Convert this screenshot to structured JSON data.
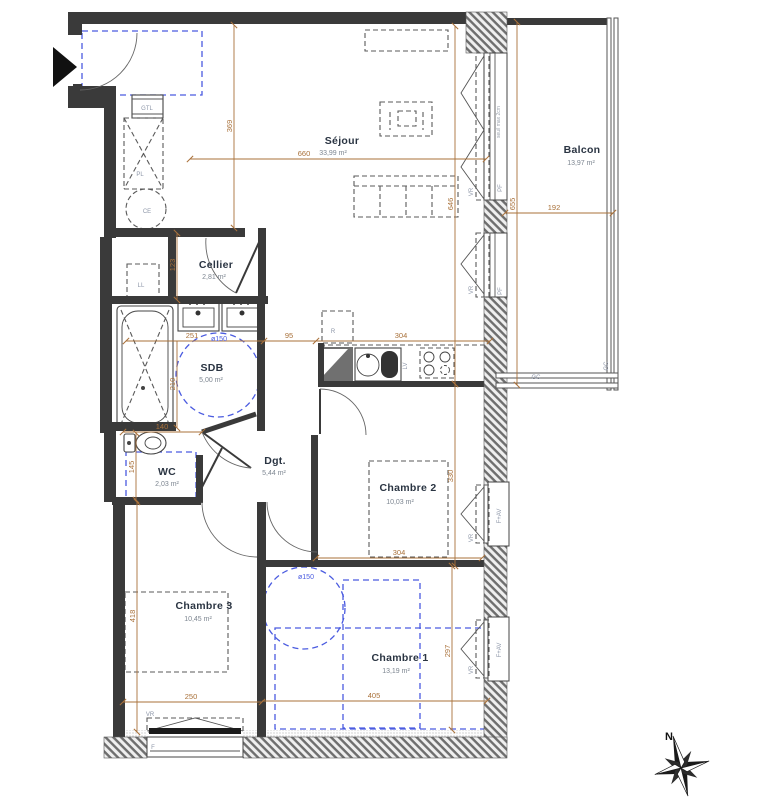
{
  "rooms": {
    "sejour": {
      "name": "Séjour",
      "area": "33,99 m²"
    },
    "balcon": {
      "name": "Balcon",
      "area": "13,97 m²"
    },
    "cellier": {
      "name": "Cellier",
      "area": "2,81 m²"
    },
    "sdb": {
      "name": "SDB",
      "area": "5,00 m²"
    },
    "wc": {
      "name": "WC",
      "area": "2,03 m²"
    },
    "dgt": {
      "name": "Dgt.",
      "area": "5,44 m²"
    },
    "chambre1": {
      "name": "Chambre 1",
      "area": "13,19 m²"
    },
    "chambre2": {
      "name": "Chambre 2",
      "area": "10,03 m²"
    },
    "chambre3": {
      "name": "Chambre 3",
      "area": "10,45 m²"
    }
  },
  "dimensions": {
    "v369": "369",
    "h660": "660",
    "v646": "646",
    "v655": "655",
    "h192": "192",
    "v123": "123",
    "h251": "251",
    "h95": "95",
    "h304": "304",
    "v210": "210",
    "h140": "140",
    "v145": "145",
    "v330": "330",
    "v418": "418",
    "h250": "250",
    "h405": "405",
    "v297": "297"
  },
  "labels": {
    "gtl": "GTL",
    "pl": "PL",
    "ce": "CE",
    "ll": "LL",
    "r": "R",
    "lv": "LV",
    "vr": "VR",
    "pf": "PF",
    "fav": "F+AV",
    "f": "F",
    "gc": "GC",
    "seuil": "seuil max 2cm",
    "d150": "ø150",
    "north": "N"
  },
  "colors": {
    "wall": "#3a3a3a",
    "dimension": "#a9713a",
    "furniture_blue": "#4a5be0",
    "room_label": "#2a3442"
  }
}
